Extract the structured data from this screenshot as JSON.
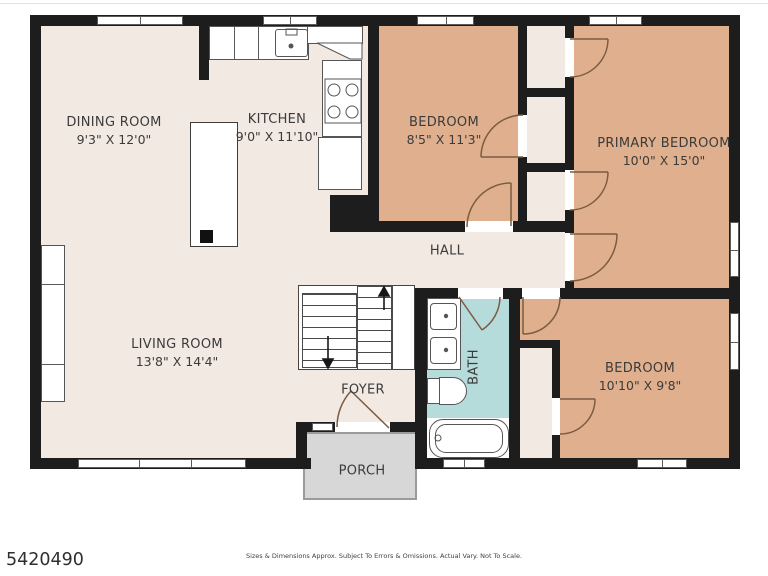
{
  "plan": {
    "rooms": [
      {
        "name": "DINING ROOM",
        "dims": "9'3\" X 12'0\""
      },
      {
        "name": "KITCHEN",
        "dims": "9'0\" X 11'10\""
      },
      {
        "name": "LIVING ROOM",
        "dims": "13'8\" X 14'4\""
      },
      {
        "name": "BEDROOM",
        "dims": "8'5\" X 11'3\""
      },
      {
        "name": "PRIMARY BEDROOM",
        "dims": "10'0\" X 15'0\""
      },
      {
        "name": "BEDROOM",
        "dims": "10'10\" X 9'8\""
      },
      {
        "name": "HALL"
      },
      {
        "name": "FOYER"
      },
      {
        "name": "BATH"
      },
      {
        "name": "PORCH"
      }
    ],
    "colors": {
      "wall": "#1d1d1d",
      "floor": "#f2e9e3",
      "bedroom": "#e0b08e",
      "bath": "#b5dbda",
      "porch": "#d7d7d7",
      "fixture_line": "#555555",
      "door_swing": "#7b5c41",
      "label_text": "#3b3b3b"
    }
  },
  "footer": {
    "listing_id": "5420490",
    "disclaimer": "Sizes & Dimensions Approx. Subject To Errors & Omissions. Actual Vary. Not To Scale."
  }
}
